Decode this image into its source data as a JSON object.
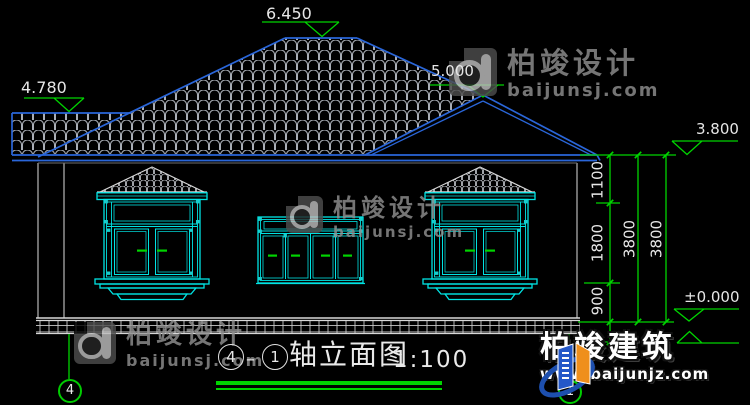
{
  "levels": {
    "main_ridge": "6.450",
    "left_ridge": "4.780",
    "right_ridge": "5.000",
    "eave": "3.800",
    "ground": "±0.000"
  },
  "dims": {
    "eave_band": "1100",
    "window_height": "1800",
    "sill_height": "900",
    "total_a": "3800",
    "total_b": "3800"
  },
  "title": {
    "axis_left": "4",
    "dash": "–",
    "axis_right": "1",
    "name": "轴立面图",
    "scale": "1:100"
  },
  "axis": {
    "left_bubble": "4",
    "right_bubble": "1"
  },
  "watermark": {
    "brand": "柏竣设计",
    "site": "baijunsj.com"
  },
  "branding": {
    "name": "柏竣建筑",
    "site": "www.baijunjz.com"
  },
  "colors": {
    "dimension_green": "#00d400",
    "window_cyan": "#00e3e3",
    "roof_blue": "#2a66d9",
    "tile_gray": "#a9aeb6",
    "wall_white": "#c9c9c9",
    "background": "#000000"
  }
}
